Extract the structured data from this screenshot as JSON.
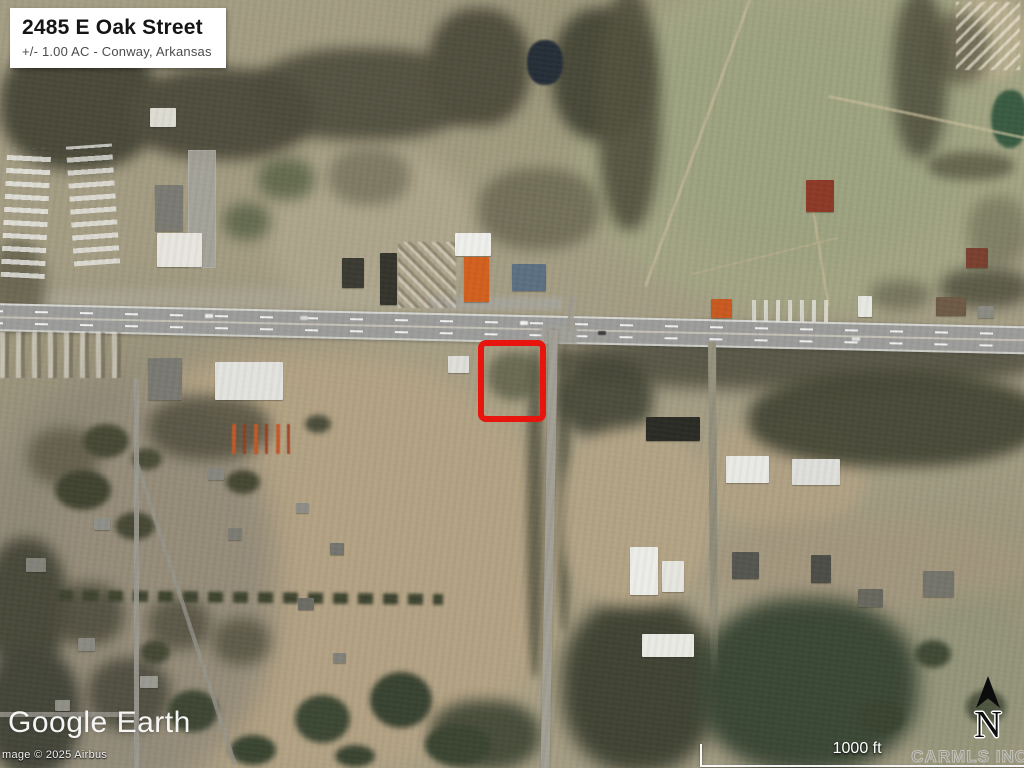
{
  "property_label": {
    "title": "2485 E Oak Street",
    "subtitle": "+/- 1.00 AC - Conway, Arkansas"
  },
  "boundary_marker": {
    "shape": "rectangle",
    "color": "#e8140e"
  },
  "branding": {
    "logo_text": "Google Earth",
    "attribution_text": "mage © 2025 Airbus",
    "mls_watermark_text": "CARMLS INC"
  },
  "scale_bar": {
    "label": "1000 ft"
  },
  "compass": {
    "label": "N"
  },
  "imagery_colors": {
    "terrain_base": "#a49d84",
    "open_field": "#b4a385",
    "pasture": "#a2a584",
    "forest": "#46483a",
    "highway": "#9c9c9a",
    "pond": "#262f38"
  }
}
